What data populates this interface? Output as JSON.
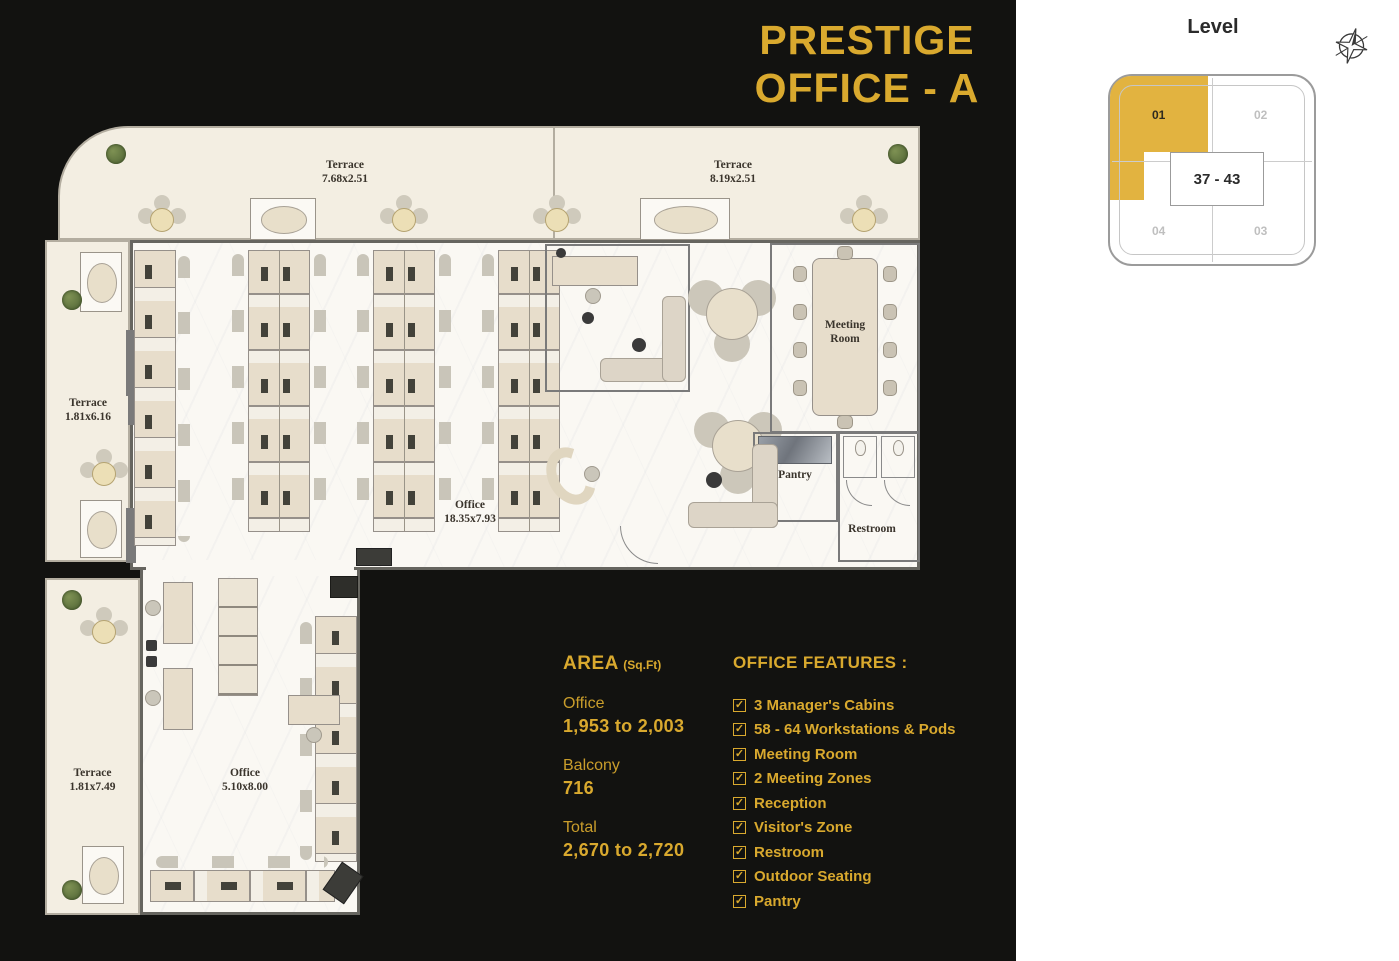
{
  "title": {
    "line1": "PRESTIGE",
    "line2": "OFFICE - A"
  },
  "level": {
    "heading": "Level",
    "range": "37 - 43",
    "quadrants": [
      {
        "label": "01",
        "active": true
      },
      {
        "label": "02",
        "active": false
      },
      {
        "label": "03",
        "active": false
      },
      {
        "label": "04",
        "active": false
      }
    ],
    "highlight_color": "#e2b340"
  },
  "plan": {
    "labels": {
      "terrace_top_left": {
        "name": "Terrace",
        "dims": "7.68x2.51"
      },
      "terrace_top_right": {
        "name": "Terrace",
        "dims": "8.19x2.51"
      },
      "terrace_left": {
        "name": "Terrace",
        "dims": "1.81x6.16"
      },
      "terrace_bottom_left": {
        "name": "Terrace",
        "dims": "1.81x7.49"
      },
      "office_main": {
        "name": "Office",
        "dims": "18.35x7.93"
      },
      "office_secondary": {
        "name": "Office",
        "dims": "5.10x8.00"
      },
      "meeting_room": {
        "name": "Meeting Room"
      },
      "pantry": {
        "name": "Pantry"
      },
      "restroom": {
        "name": "Restroom"
      }
    }
  },
  "area": {
    "heading": "AREA",
    "unit": "(Sq.Ft)",
    "items": [
      {
        "label": "Office",
        "value": "1,953 to 2,003"
      },
      {
        "label": "Balcony",
        "value": "716"
      },
      {
        "label": "Total",
        "value": "2,670 to 2,720"
      }
    ]
  },
  "features": {
    "heading": "OFFICE FEATURES :",
    "checkbox_glyph": "✓",
    "items": [
      "3 Manager's Cabins",
      "58 - 64 Workstations & Pods",
      "Meeting Room",
      "2 Meeting Zones",
      "Reception",
      "Visitor's Zone",
      "Restroom",
      "Outdoor Seating",
      "Pantry"
    ]
  },
  "colors": {
    "accent": "#d9a92e",
    "background": "#121210",
    "highlight": "#e2b340"
  }
}
